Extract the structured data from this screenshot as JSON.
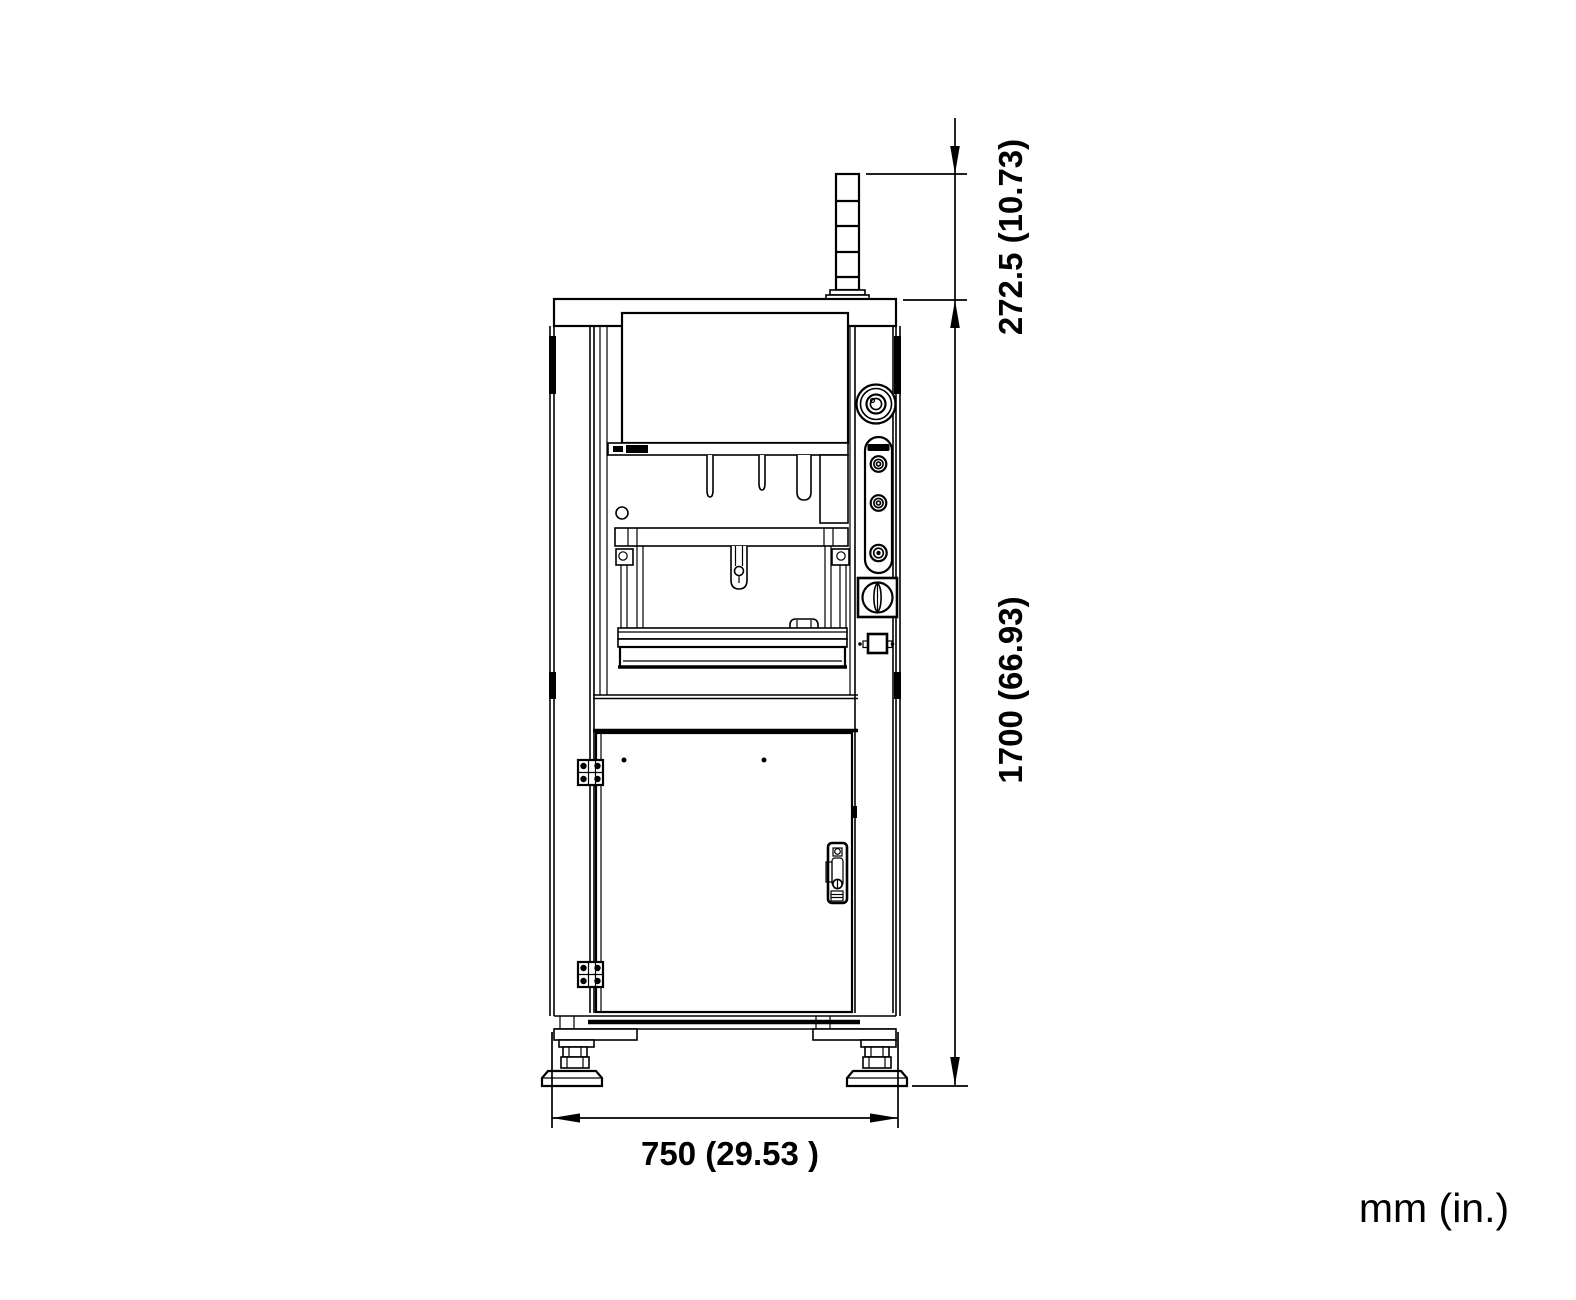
{
  "drawing": {
    "units_label": "mm (in.)",
    "dimensions": {
      "tower_height": {
        "mm": "272.5",
        "inches": "10.73",
        "label": "272.5 (10.73)"
      },
      "overall_height": {
        "mm": "1700",
        "inches": "66.93",
        "label": "1700 (66.93)"
      },
      "overall_width": {
        "mm": "750",
        "inches": "29.53",
        "label": "750 (29.53 )"
      }
    }
  }
}
